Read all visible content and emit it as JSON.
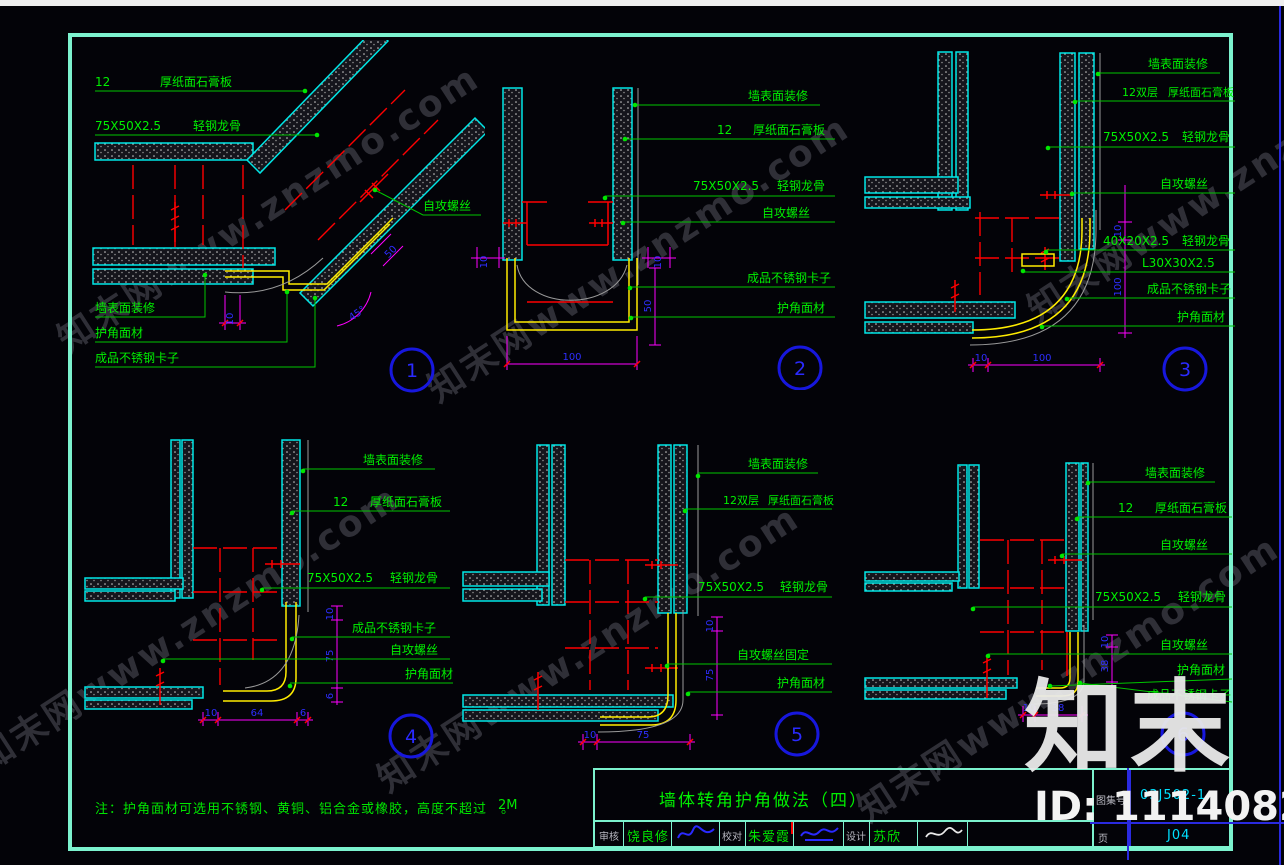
{
  "watermark": {
    "tile": "知末网www.znzmo.com",
    "logo": "知末",
    "id_text": "ID: 1114082388"
  },
  "note": {
    "text": "注：护角面材可选用不锈钢、黄铜、铝合金或橡胶，高度不超过　。",
    "height": "2M"
  },
  "titleblock": {
    "title": "墙体转角护角做法（四）",
    "atlas_label": "图集号",
    "atlas_no": "03J502-1",
    "page_label": "页",
    "page_no": "J04",
    "cells": [
      {
        "label": "审核",
        "name": "饶良修"
      },
      {
        "label": "校对",
        "name": "朱爱霞"
      },
      {
        "label": "设计",
        "name": "苏欣"
      }
    ]
  },
  "details": [
    {
      "no": "1",
      "board_qty": "12",
      "board": "厚纸面石膏板",
      "keel_spec": "75X50X2.5",
      "keel": "轻钢龙骨",
      "screw": "自攻螺丝",
      "wall": "墙表面装修",
      "guard": "护角面材",
      "clip": "成品不锈钢卡子",
      "dim_w": "10",
      "dim_d": "50",
      "dim_a": "45°"
    },
    {
      "no": "2",
      "wall": "墙表面装修",
      "board_qty": "12",
      "board": "厚纸面石膏板",
      "keel_spec": "75X50X2.5",
      "keel": "轻钢龙骨",
      "screw": "自攻螺丝",
      "clip": "成品不锈钢卡子",
      "guard": "护角面材",
      "dim_l": "10",
      "dim_r": "10",
      "dim_h": "50",
      "dim_w": "100"
    },
    {
      "no": "3",
      "wall": "墙表面装修",
      "board_qty": "12双层",
      "board": "厚纸面石膏板",
      "keel_spec": "75X50X2.5",
      "keel": "轻钢龙骨",
      "screw": "自攻螺丝",
      "keel2_spec": "40X20X2.5",
      "keel2": "轻钢龙骨",
      "angle": "L30X30X2.5",
      "clip": "成品不锈钢卡子",
      "guard": "护角面材",
      "dims_bottom": [
        "10",
        "100"
      ],
      "dims_right": [
        "10",
        "100"
      ]
    },
    {
      "no": "4",
      "wall": "墙表面装修",
      "board_qty": "12",
      "board": "厚纸面石膏板",
      "keel_spec": "75X50X2.5",
      "keel": "轻钢龙骨",
      "clip": "成品不锈钢卡子",
      "screw": "自攻螺丝",
      "guard": "护角面材",
      "dims_bottom": [
        "10",
        "64",
        "6"
      ],
      "dims_right": [
        "10",
        "75",
        "6"
      ]
    },
    {
      "no": "5",
      "wall": "墙表面装修",
      "board_qty": "12双层",
      "board": "厚纸面石膏板",
      "keel_spec": "75X50X2.5",
      "keel": "轻钢龙骨",
      "screw": "自攻螺丝固定",
      "guard": "护角面材",
      "dims_bottom": [
        "10",
        "75"
      ],
      "dims_right": [
        "10",
        "75"
      ]
    },
    {
      "no": "6",
      "wall": "墙表面装修",
      "board_qty": "12",
      "board": "厚纸面石膏板",
      "screw1": "自攻螺丝",
      "keel_spec": "75X50X2.5",
      "keel": "轻钢龙骨",
      "screw2": "自攻螺丝",
      "guard": "护角面材",
      "clip": "成品不锈钢卡子",
      "dims_bottom": [
        "10",
        "38"
      ],
      "dims_right": [
        "10",
        "38"
      ]
    }
  ]
}
